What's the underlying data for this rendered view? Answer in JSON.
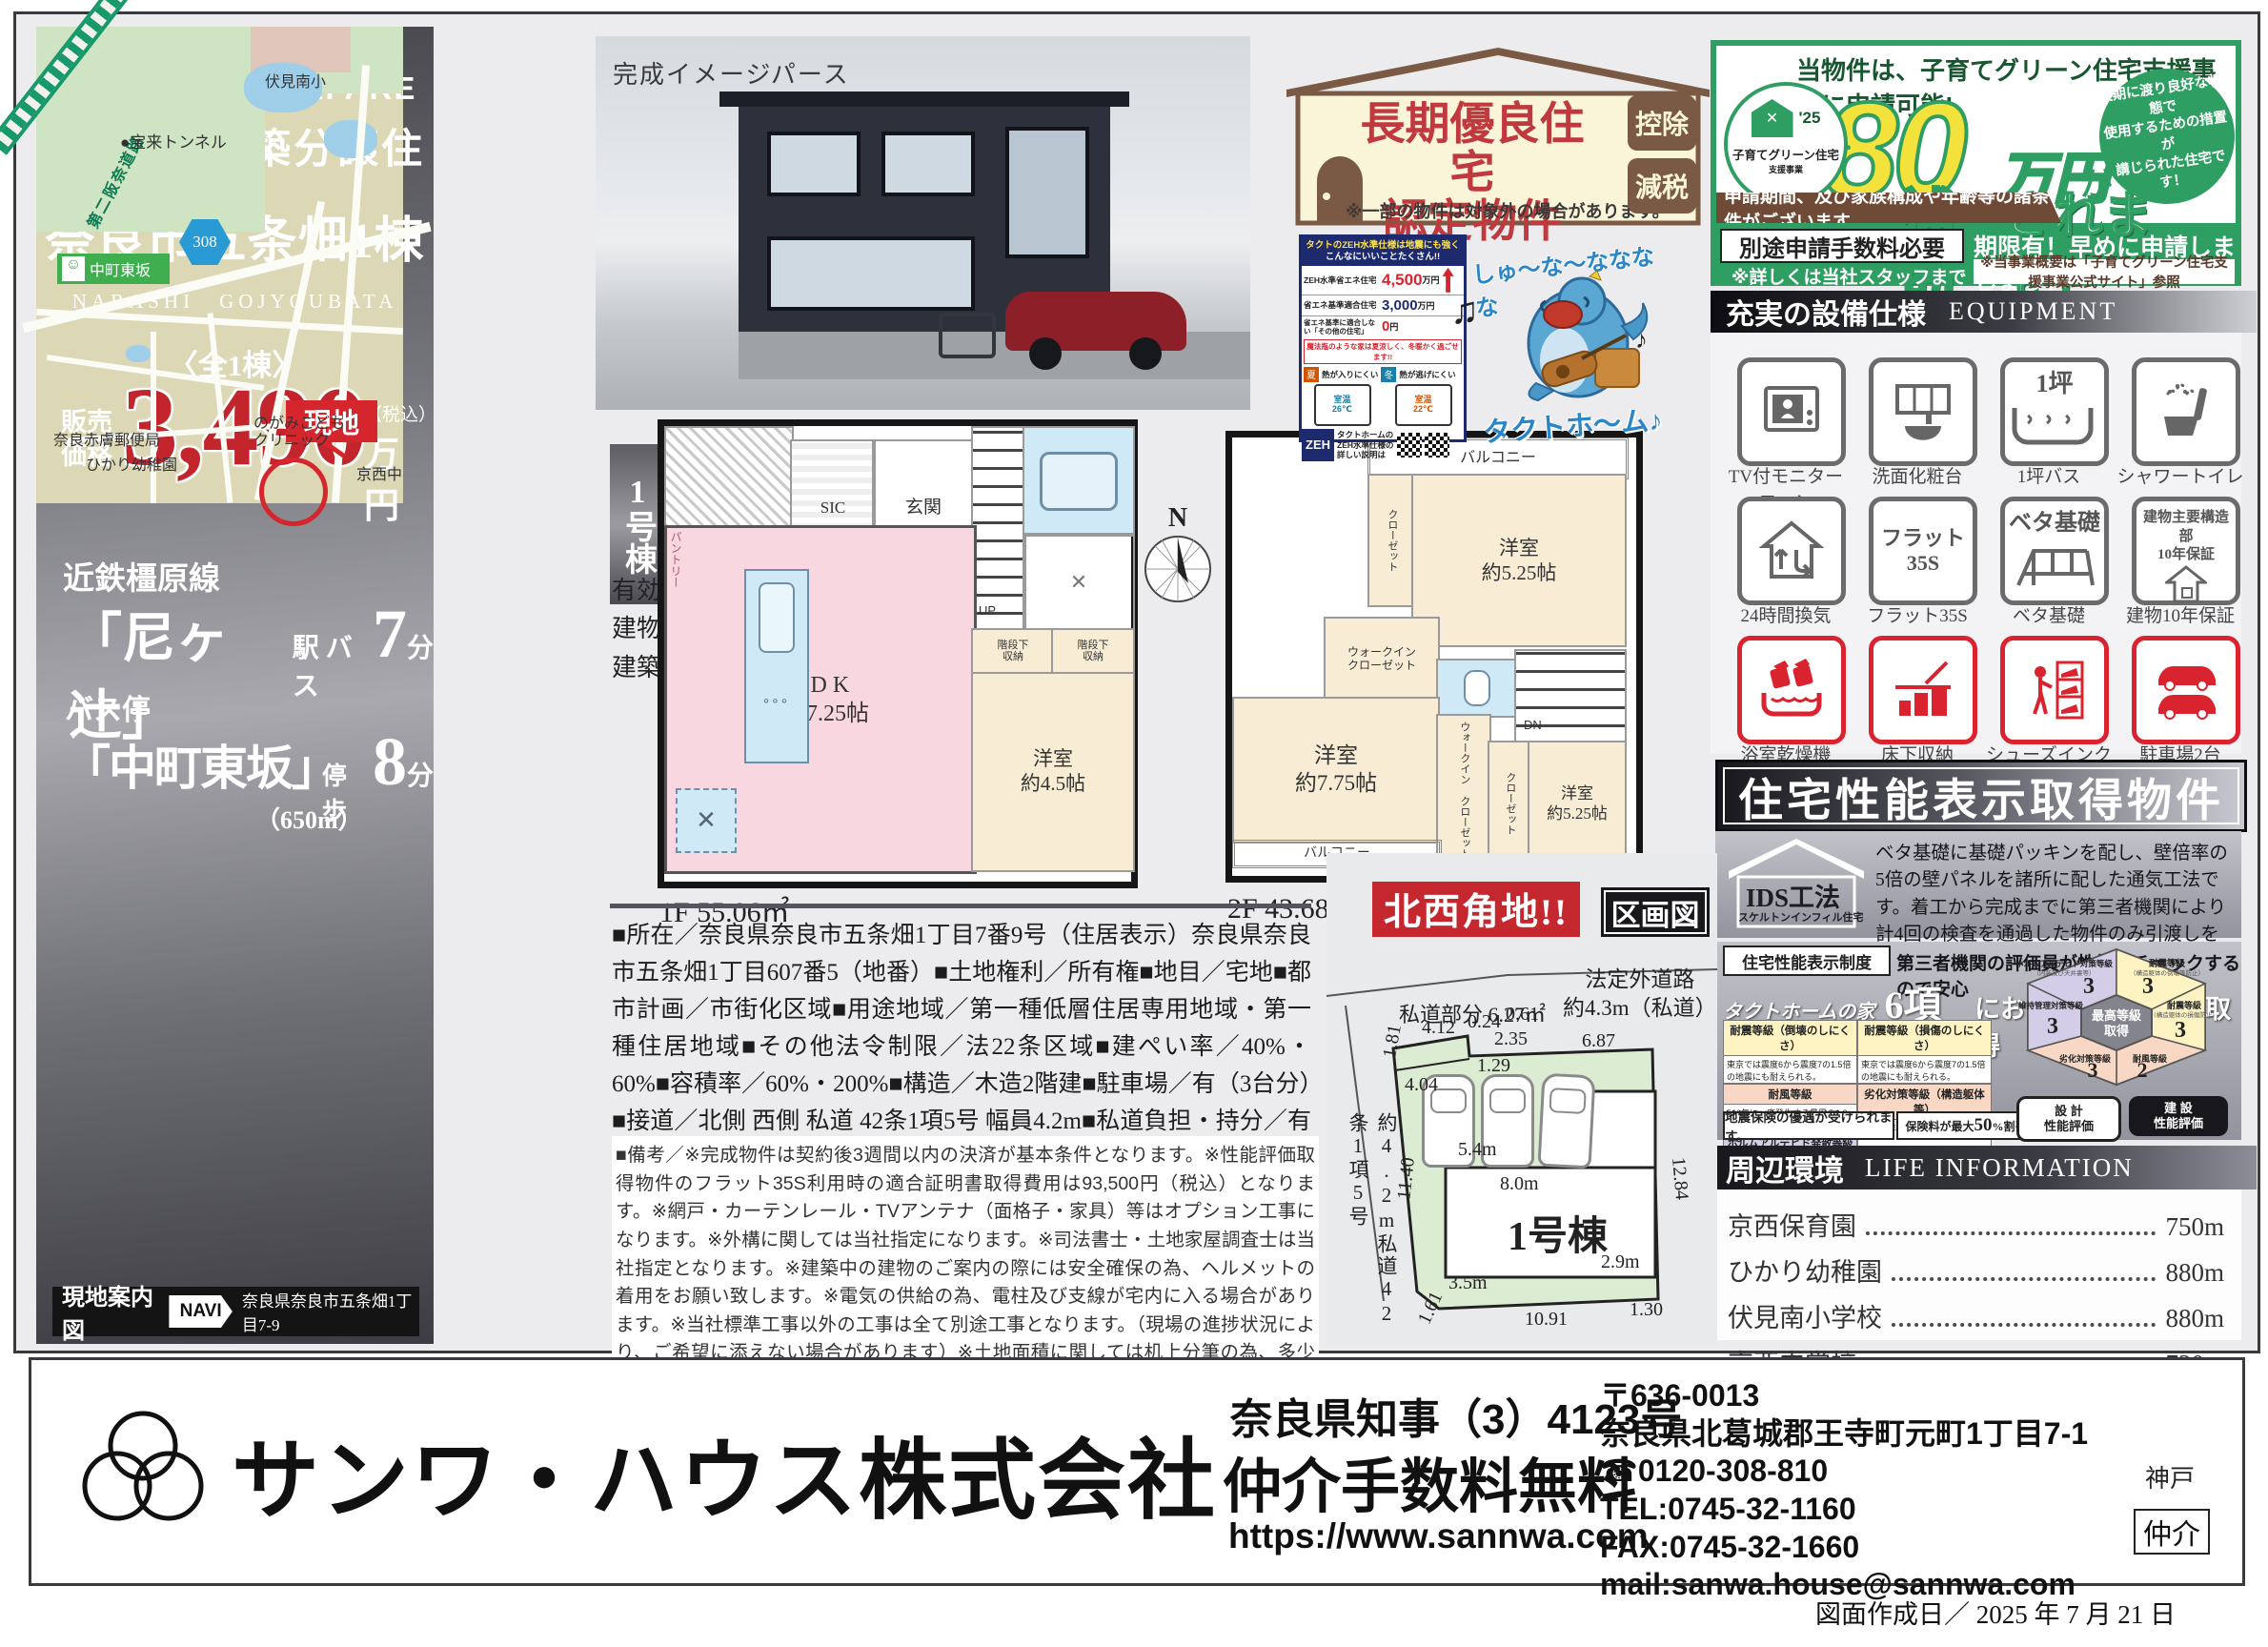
{
  "left": {
    "zeh": {
      "brand": "GRAFARE",
      "tagline": "次世代につなげる",
      "name": "ZEH",
      "spec": "水準仕様"
    },
    "logo": "GRAFARE",
    "subtitle": "新築分譲住宅",
    "title": "奈良市五条畑1棟",
    "romaji": "NARASHI　GOJYOUBATA",
    "count": "〈全1棟〉",
    "price": {
      "l1": "販売",
      "l2": "価格",
      "value": "3,490",
      "tax": "（税込）",
      "unit": "万円"
    },
    "access": {
      "rail": "近鉄橿原線",
      "station": "「尼ヶ辻」",
      "mode": "駅 バス",
      "min": "7",
      "unit": "分",
      "bus_label": "バス停",
      "bus_stop": "「中町東坂」",
      "bus_mode": "停歩",
      "bus_min": "8",
      "dist": "（650m）"
    },
    "map": {
      "expy": "第二阪奈道路",
      "tunnel": "●宝来トンネル",
      "school_n": "伏見南小",
      "busstop": "中町東坂",
      "route": "308",
      "site": "現地",
      "post": "奈良赤膚郵便局",
      "kinder": "ひかり幼稚園",
      "clinic": "のがみこども\nクリニック",
      "school_s": "京西中"
    },
    "navi": {
      "label": "現地案内図",
      "badge": "NAVI",
      "address": "奈良県奈良市五条畑1丁目7-9"
    }
  },
  "render": {
    "caption": "完成イメージパース"
  },
  "unit": {
    "badge": "1号棟",
    "plan": "4LDK",
    "plus1": "+SIC",
    "plus2": "+2WIC",
    "land": "有効敷地面積：175.96㎡（53.22坪）",
    "building": "建物面積：98.74㎡（29.86坪）",
    "permit": "建築確認番号：第 HPA-25-06815-1 号"
  },
  "f1": {
    "area": "1F 55.06㎡",
    "ldk": "L D K\n約17.25帖",
    "room": "洋室\n約4.5帖",
    "genkan": "玄関",
    "sic": "SIC",
    "storage": "収納",
    "pantry": "パントリー",
    "under": "階段下\n収納",
    "up": "UP",
    "wash": "✕"
  },
  "f2": {
    "area": "2F 43.68㎡",
    "balcony": "バルコニー",
    "room_a": "洋室\n約5.25帖",
    "room_b": "洋室\n約7.75帖",
    "room_c": "洋室\n約5.25帖",
    "wic": "ウォークイン\nクローゼット",
    "closet": "クローゼット",
    "dn": "DN",
    "north": "N"
  },
  "details": "■所在／奈良県奈良市五条畑1丁目7番9号（住居表示）奈良県奈良市五条畑1丁目607番5（地番）■土地権利／所有権■地目／宅地■都市計画／市街化区域■用途地域／第一種低層住居専用地域・第一種住居地域■その他法令制限／法22条区域■建ぺい率／40%・60%■容積率／60%・200%■構造／木造2階建■駐車場／有（3台分）■接道／北側 西側 私道 42条1項5号 幅員4.2m■私道負担・持分／有■私道詳細／6.27㎡■現況／上物有■完成／2025年10月下旬予定■引渡／2025年11月中旬予定■設備／関西電力・都市ガス・公営水道・公共下水■備考／※網戸設置及びカーテンレール設置は当社指定業者にて施工必須とします。※設置費用192,500円（税込）",
  "remarks": "■備考／※完成物件は契約後3週間以内の決済が基本条件となります。※性能評価取得物件のフラット35S利用時の適合証明書取得費用は93,500円（税込）となります。※網戸・カーテンレール・TVアンテナ（面格子・家具）等はオプション工事になります。※外構に関しては当社指定になります。※司法書士・土地家屋調査士は当社指定となります。※建築中の建物のご案内の際には安全確保の為、ヘルメットの着用をお願い致します。※電気の供給の為、電柱及び支線が宅内に入る場合があります。※当社標準工事以外の工事は全て別途工事となります。（現場の進捗状況により、ご希望に添えない場合があります）※土地面積に関しては机上分筆の為、多少増減がある場合があります。（増減精算は致しません）※ケーブルTV、共聴アンテナの引込はお客様の負担となり、電波障害に付きましては当社は責任を負いません。※当社指定外のガス会社ご利用の際は設備買取りが別途必要になります。※浄化槽の場合は、法定検査料が別途必要になります。※図面及びイメージパースが現況と異なる場合は現況優先とします。",
  "cert": {
    "line1": "長期優良住宅",
    "line2": "認定物件",
    "note": "※一部の物件は対象外の場合があります。",
    "badge1": "控除",
    "badge2": "減税"
  },
  "tact": {
    "h1": "タクトのZEH水準仕様は地震にも強く",
    "h2": "こんなにいいことたくさん!!",
    "r1l": "ZEH水準省エネ住宅",
    "r1v": "4,500",
    "r1u": "万円",
    "r2l": "省エネ基準適合住宅",
    "r2v": "3,000",
    "r2u": "万円",
    "r3l": "省エネ基準に適合しない「その他の住宅」",
    "r3v": "0",
    "r3u": "円",
    "note": "魔法瓶のような家は夏涼しく、冬暖かく過ごせます!!",
    "sum_b": "夏",
    "sum_t": "熱が入りにくい",
    "sum_temp": "室温\n26℃",
    "win_b": "冬",
    "win_t": "熱が逃げにくい",
    "win_temp": "室温\n22℃",
    "zeh": "ZEH",
    "footer": "タクトホームの\nZEH水準仕様の\n詳しい説明は"
  },
  "mascot": {
    "song": "しゅ〜な〜なななな",
    "name": "タクトホ〜ム♪"
  },
  "subsidy": {
    "top": "当物件は、子育てグリーン住宅支援事業に申請可能!",
    "badge1": "子育てグリーン住宅",
    "badge2": "支援事業",
    "badge3": "'25",
    "amount": "80",
    "unit": "万円",
    "ga": "が",
    "hojo": "補助",
    "saremasu": "されます！",
    "bubble": "長期に渡り良好な状態で\n使用するための措置が\n講じられた住宅です！",
    "cond": "申請期間、及び家族構成や年齢等の諸条件がございます",
    "fee": "別途申請手数料必要",
    "fee_note": "※詳しくは当社スタッフまで",
    "deadline": "期限有！早めに申請しましょう！",
    "deadline_note": "※当事業概要は「子育てグリーン住宅支援事業公式サイト」参照"
  },
  "equip": {
    "title": "充実の設備仕様",
    "en": "EQUIPMENT",
    "items": [
      {
        "label": "TV付モニターフォン"
      },
      {
        "label": "洗面化粧台"
      },
      {
        "label": "1坪バス",
        "icon_text": "1坪"
      },
      {
        "label": "シャワートイレ"
      },
      {
        "label": "24時間換気"
      },
      {
        "label": "フラット35S",
        "icon_text": "フラット\n35S"
      },
      {
        "label": "ベタ基礎",
        "icon_text": "ベタ基礎"
      },
      {
        "label": "建物10年保証",
        "icon_text": "建物主要構造部\n10年保証"
      },
      {
        "label": "浴室乾燥機"
      },
      {
        "label": "床下収納"
      },
      {
        "label": "シューズインクローク"
      },
      {
        "label": "駐車場2台"
      }
    ]
  },
  "perf": {
    "title": "住宅性能表示取得物件",
    "ids": "IDS工法",
    "ids_sub": "スケルトンインフィル住宅",
    "ids_text": "ベタ基礎に基礎パッキンを配し、壁倍率の5倍の壁パネルを諸所に配した通気工法です。着工から完成までに第三者機関により計4回の検査を通過した物件のみ引渡しを行います。",
    "sys": "住宅性能表示制度",
    "sys_text": "第三者機関の評価員が性能をチェックするので安心",
    "hl1": "タクトホームの家は",
    "hl2": "6項目",
    "hl3": "において最高等級を取得",
    "rows": [
      {
        "h": "耐震等級（倒壊のしにくさ）",
        "b": "東京では震度6から震度7の1.5倍の地震にも耐えられる。"
      },
      {
        "h": "耐震等級（損傷のしにくさ）",
        "b": "東京では震度6から震度7の1.5倍の地震にも耐えられる。"
      },
      {
        "h": "耐風等級",
        "b": "500年に一度発生する暴風の1.2倍に対しても倒壊しない。"
      },
      {
        "h": "劣化対策等級（構造躯体等）",
        "b": "概ね75年から90年もつ住宅。"
      },
      {
        "h": "ホルムアルデヒド発散等級",
        "b": "居室の内装材からのホルムアルデヒドの放散量を少なくする対策。"
      },
      {
        "h": "維持管理対策等級",
        "b": "専用の給排水管・ガス管の維持管理を容易とするために必要な対策。"
      }
    ],
    "hex": {
      "c1": "最高等級",
      "c2": "取得",
      "tl": "ホルムアルデヒド対策等級",
      "tl_s": "（内装及び天井裏等）",
      "tl_v": "3",
      "tr": "耐震等級",
      "tr_s": "（構造躯体の倒壊等防止）",
      "tr_v": "3",
      "l": "維持管理対策等級",
      "l_v": "3",
      "r": "耐震等級",
      "r_s": "（構造躯体の損傷防止）",
      "r_v": "3",
      "bl": "劣化対策等級",
      "bl_v": "3",
      "br": "耐風等級",
      "br_v": "2"
    },
    "ins1": "地震保険の優遇が受けられます。",
    "ins2a": "保険料が最大",
    "ins2b": "50",
    "ins2c": "%割引",
    "bdg1": "設 計\n性能評価",
    "bdg2": "建 設\n性能評価"
  },
  "life": {
    "title": "周辺環境",
    "en": "LIFE INFORMATION",
    "items": [
      {
        "name": "京西保育園",
        "dist": "750m"
      },
      {
        "name": "ひかり幼稚園",
        "dist": "880m"
      },
      {
        "name": "伏見南小学校",
        "dist": "880m"
      },
      {
        "name": "京西中学校",
        "dist": "720m"
      },
      {
        "name": "業務スーパー　富雄中町店",
        "dist": "1,800m"
      }
    ]
  },
  "site": {
    "corner": "北西角地!!",
    "label": "区画図",
    "shidou": "私道部分 6.27㎡",
    "road_r": "法定外道路\n約4.3m（私道）",
    "road_l": "約4.2m私道42条1項5号",
    "unit": "1号棟",
    "dims": [
      "4.12",
      "0.24",
      "0.61",
      "2.35",
      "1.29",
      "6.87",
      "1.81",
      "4.04",
      "5.4m",
      "8.0m",
      "11.40",
      "12.84",
      "3.5m",
      "2.9m",
      "10.91",
      "1.30",
      "1.61"
    ]
  },
  "footer": {
    "company": "サンワ・ハウス株式会社",
    "license": "奈良県知事（3）4123号",
    "fee": "仲介手数料無料",
    "url": "https://www.sannwa.com",
    "postal": "〒636-0013",
    "address": "奈良県北葛城郡王寺町元町1丁目7-1",
    "freedial": "☎0120-308-810",
    "tel": "TEL:0745-32-1160",
    "fax": "FAX:0745-32-1660",
    "mail": "mail:sanwa.house@sannwa.com",
    "note": "神戸",
    "badge": "仲介",
    "date": "図面作成日／ 2025 年 7 月 21 日"
  }
}
